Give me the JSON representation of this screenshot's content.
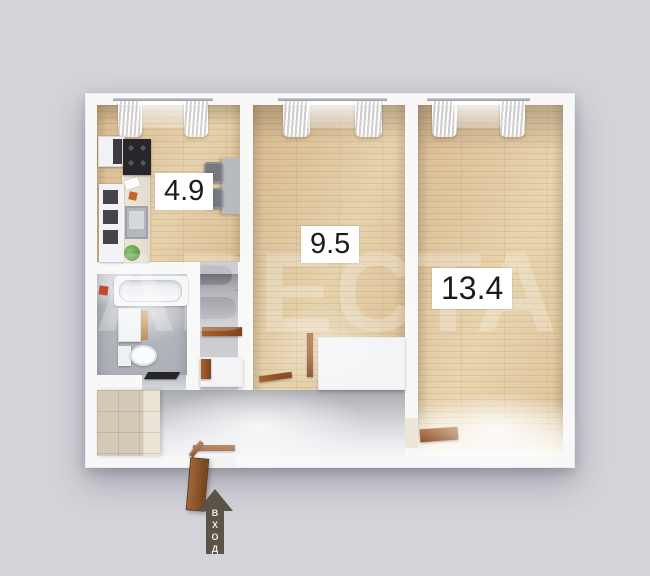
{
  "plan": {
    "type": "apartment-floor-plan",
    "rooms": [
      {
        "id": "kitchen",
        "area": "4.9"
      },
      {
        "id": "room-medium",
        "area": "9.5"
      },
      {
        "id": "room-large",
        "area": "13.4"
      }
    ],
    "entrance": {
      "label": "ВХОД",
      "icon": "arrow-up-icon"
    },
    "watermark": "АВЕСТА",
    "colors": {
      "background": "#d3d3d9",
      "walls": "#f8f8f9",
      "wood_floor": "#ddc29a",
      "bathroom_floor": "#b5b8bf",
      "hallway_floor": "#c7c9ce",
      "door_wood": "#9b5626",
      "entrance_arrow": "#5b5349",
      "label_background": "#ffffff",
      "label_text": "#1b1b1d"
    }
  }
}
